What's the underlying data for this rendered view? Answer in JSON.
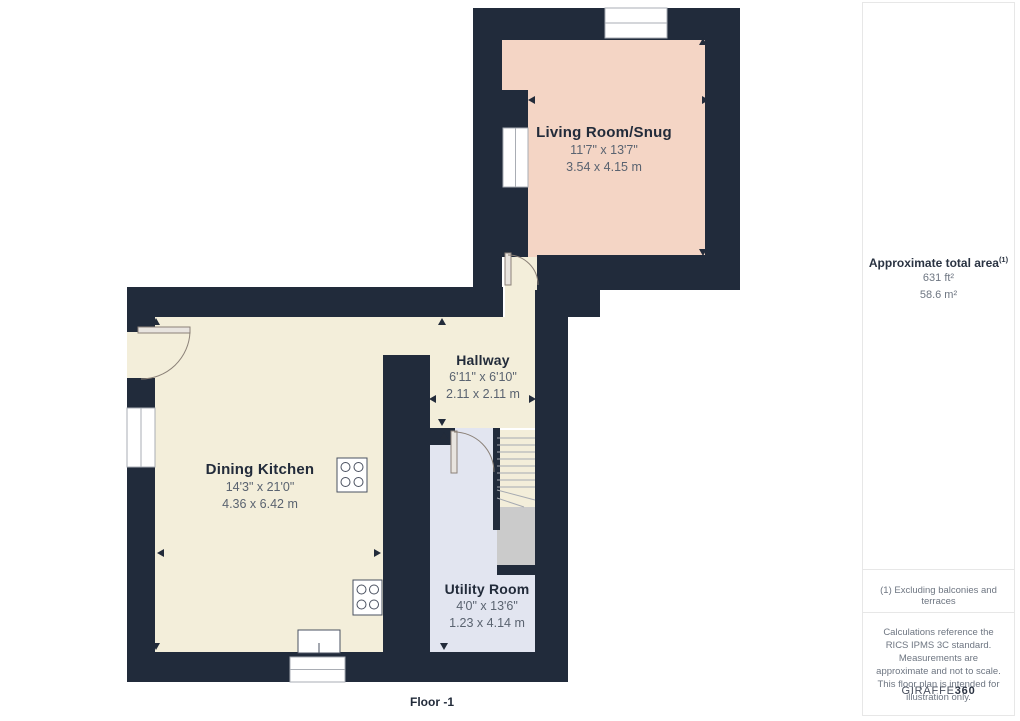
{
  "floor_plan": {
    "floor_label": "Floor -1",
    "rooms": [
      {
        "name": "Living Room/Snug",
        "imperial": "11'7\" x 13'7\"",
        "metric": "3.54 x 4.15 m"
      },
      {
        "name": "Hallway",
        "imperial": "6'11\" x 6'10\"",
        "metric": "2.11 x 2.11 m"
      },
      {
        "name": "Dining Kitchen",
        "imperial": "14'3\" x 21'0\"",
        "metric": "4.36 x 6.42 m"
      },
      {
        "name": "Utility Room",
        "imperial": "4'0\" x 13'6\"",
        "metric": "1.23 x 4.14 m"
      }
    ],
    "colors": {
      "wall": "#212b3b",
      "living_room_fill": "#f4d5c5",
      "kitchen_hallway_fill": "#f3eeda",
      "utility_fill": "#e2e5f0",
      "stairs_fill": "#cbcbcb"
    }
  },
  "sidebar": {
    "area_title": "Approximate total area",
    "area_note_ref": "(1)",
    "area_imperial": "631 ft²",
    "area_metric": "58.6 m²",
    "footnote": "(1) Excluding balconies and terraces",
    "disclaimer": "Calculations reference the RICS IPMS 3C standard. Measurements are approximate and not to scale. This floor plan is intended for illustration only.",
    "brand_name": "GIRAFFE",
    "brand_suffix": "360"
  }
}
